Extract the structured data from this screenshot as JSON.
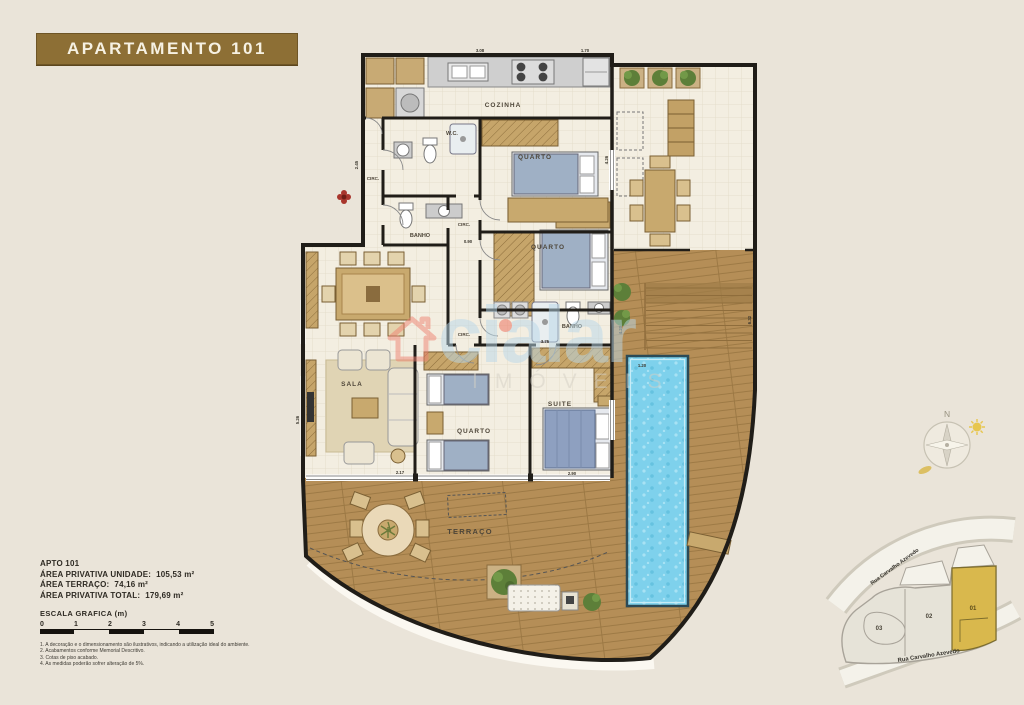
{
  "header": {
    "title": "APARTAMENTO 101"
  },
  "floorplan": {
    "rooms": [
      {
        "label": "COZINHA"
      },
      {
        "label": "W.C."
      },
      {
        "label": "QUARTO"
      },
      {
        "label": "CIRC."
      },
      {
        "label": "BANHO"
      },
      {
        "label": "CIRC."
      },
      {
        "label": "QUARTO"
      },
      {
        "label": "BANHO"
      },
      {
        "label": "CIRC."
      },
      {
        "label": "SALA"
      },
      {
        "label": "QUARTO"
      },
      {
        "label": "SUITE"
      },
      {
        "label": "TERRAÇO"
      }
    ],
    "dimensions": [
      "3.08",
      "1.70",
      "2.45",
      "0.90",
      "3.75",
      "4.20",
      "2.90",
      "1.20",
      "5.26",
      "6.32",
      "4.26",
      "2.17"
    ]
  },
  "watermark": {
    "brand": "cialar",
    "subtitle": "IMÓVEIS"
  },
  "areas": {
    "heading": "APTO 101",
    "items": [
      {
        "label": "ÁREA PRIVATIVA UNIDADE:",
        "value": "105,53 m²"
      },
      {
        "label": "ÁREA TERRAÇO:",
        "value": "74,16 m²"
      },
      {
        "label": "ÁREA PRIVATIVA TOTAL:",
        "value": "179,69 m²"
      }
    ]
  },
  "scale": {
    "label": "ESCALA GRAFICA (m)",
    "ticks": [
      "0",
      "1",
      "2",
      "3",
      "4",
      "5"
    ]
  },
  "notes": [
    "1. A decoração e o dimensionamento são ilustrativos, indicando a utilização ideal do ambiente.",
    "2. Acabamentos conforme Memorial Descritivo.",
    "3. Cotas de piso acabado.",
    "4. As medidas poderão sofrer alteração de 5%."
  ],
  "compass": {
    "north": "N"
  },
  "siteplan": {
    "street_top": "Rua Carvalho Azevedo",
    "street_bottom": "Rua Carvalho Azevedo",
    "units": [
      {
        "label": "03"
      },
      {
        "label": "02"
      },
      {
        "label": "01"
      }
    ],
    "highlight_color": "#d9b84d"
  }
}
